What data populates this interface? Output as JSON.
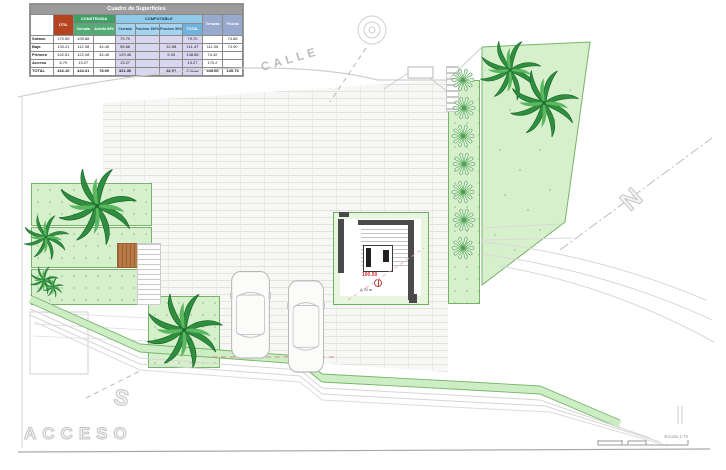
{
  "surface_table": {
    "title": "Cuadro de Superficies",
    "red_header": "ÚTIL",
    "groups": {
      "construida": "CONSTRUIDA",
      "computable": "COMPUTABLE"
    },
    "sub_headers": [
      "Cerrada",
      "Abierta 50%",
      "Cerrada",
      "Porches 100%",
      "Porches 50%",
      "TOTAL"
    ],
    "tail_headers": [
      "Terrazas",
      "Piscina"
    ],
    "rows": [
      {
        "label": "Sótano",
        "cells": [
          "170.55",
          "195.88",
          "",
          "79.70",
          "",
          "",
          "79.70",
          "",
          "74.86"
        ]
      },
      {
        "label": "Baja",
        "cells": [
          "133.21",
          "112.08",
          "44.45",
          "98.88",
          "",
          "12.58",
          "111.47",
          "111.08",
          "74.90"
        ]
      },
      {
        "label": "Primera",
        "cells": [
          "102.51",
          "122.08",
          "34.45",
          "129.45",
          "",
          "9.43",
          "138.88",
          "74.32",
          ""
        ]
      },
      {
        "label": "Acceso",
        "cells": [
          "6.70",
          "13.27",
          "",
          "13.27",
          "",
          "",
          "13.27",
          "170.2",
          ""
        ]
      },
      {
        "label": "TOTAL",
        "cells": [
          "416.10",
          "443.31",
          "78.90",
          "321.30",
          "",
          "22.01",
          "343.32",
          "355.60",
          "149.76"
        ]
      }
    ]
  },
  "plan": {
    "street_label": "CALLE",
    "access_label": "ACCESO",
    "letter_s": "S",
    "letter_n": "N",
    "level_value": "100.50",
    "area_note": "4,70 m",
    "scale_label": "Escala 1:75"
  },
  "colors": {
    "green_fill": "#d7f0cc",
    "green_border": "#76b26a",
    "palm_green": "#2f8f3f",
    "wall_gray": "#4a4a4a",
    "level_red": "#cc3333",
    "table_red": "#b5431f",
    "table_green": "#3fa066",
    "table_blue": "#8fcbe8",
    "table_lavender": "#d9d6ef"
  }
}
